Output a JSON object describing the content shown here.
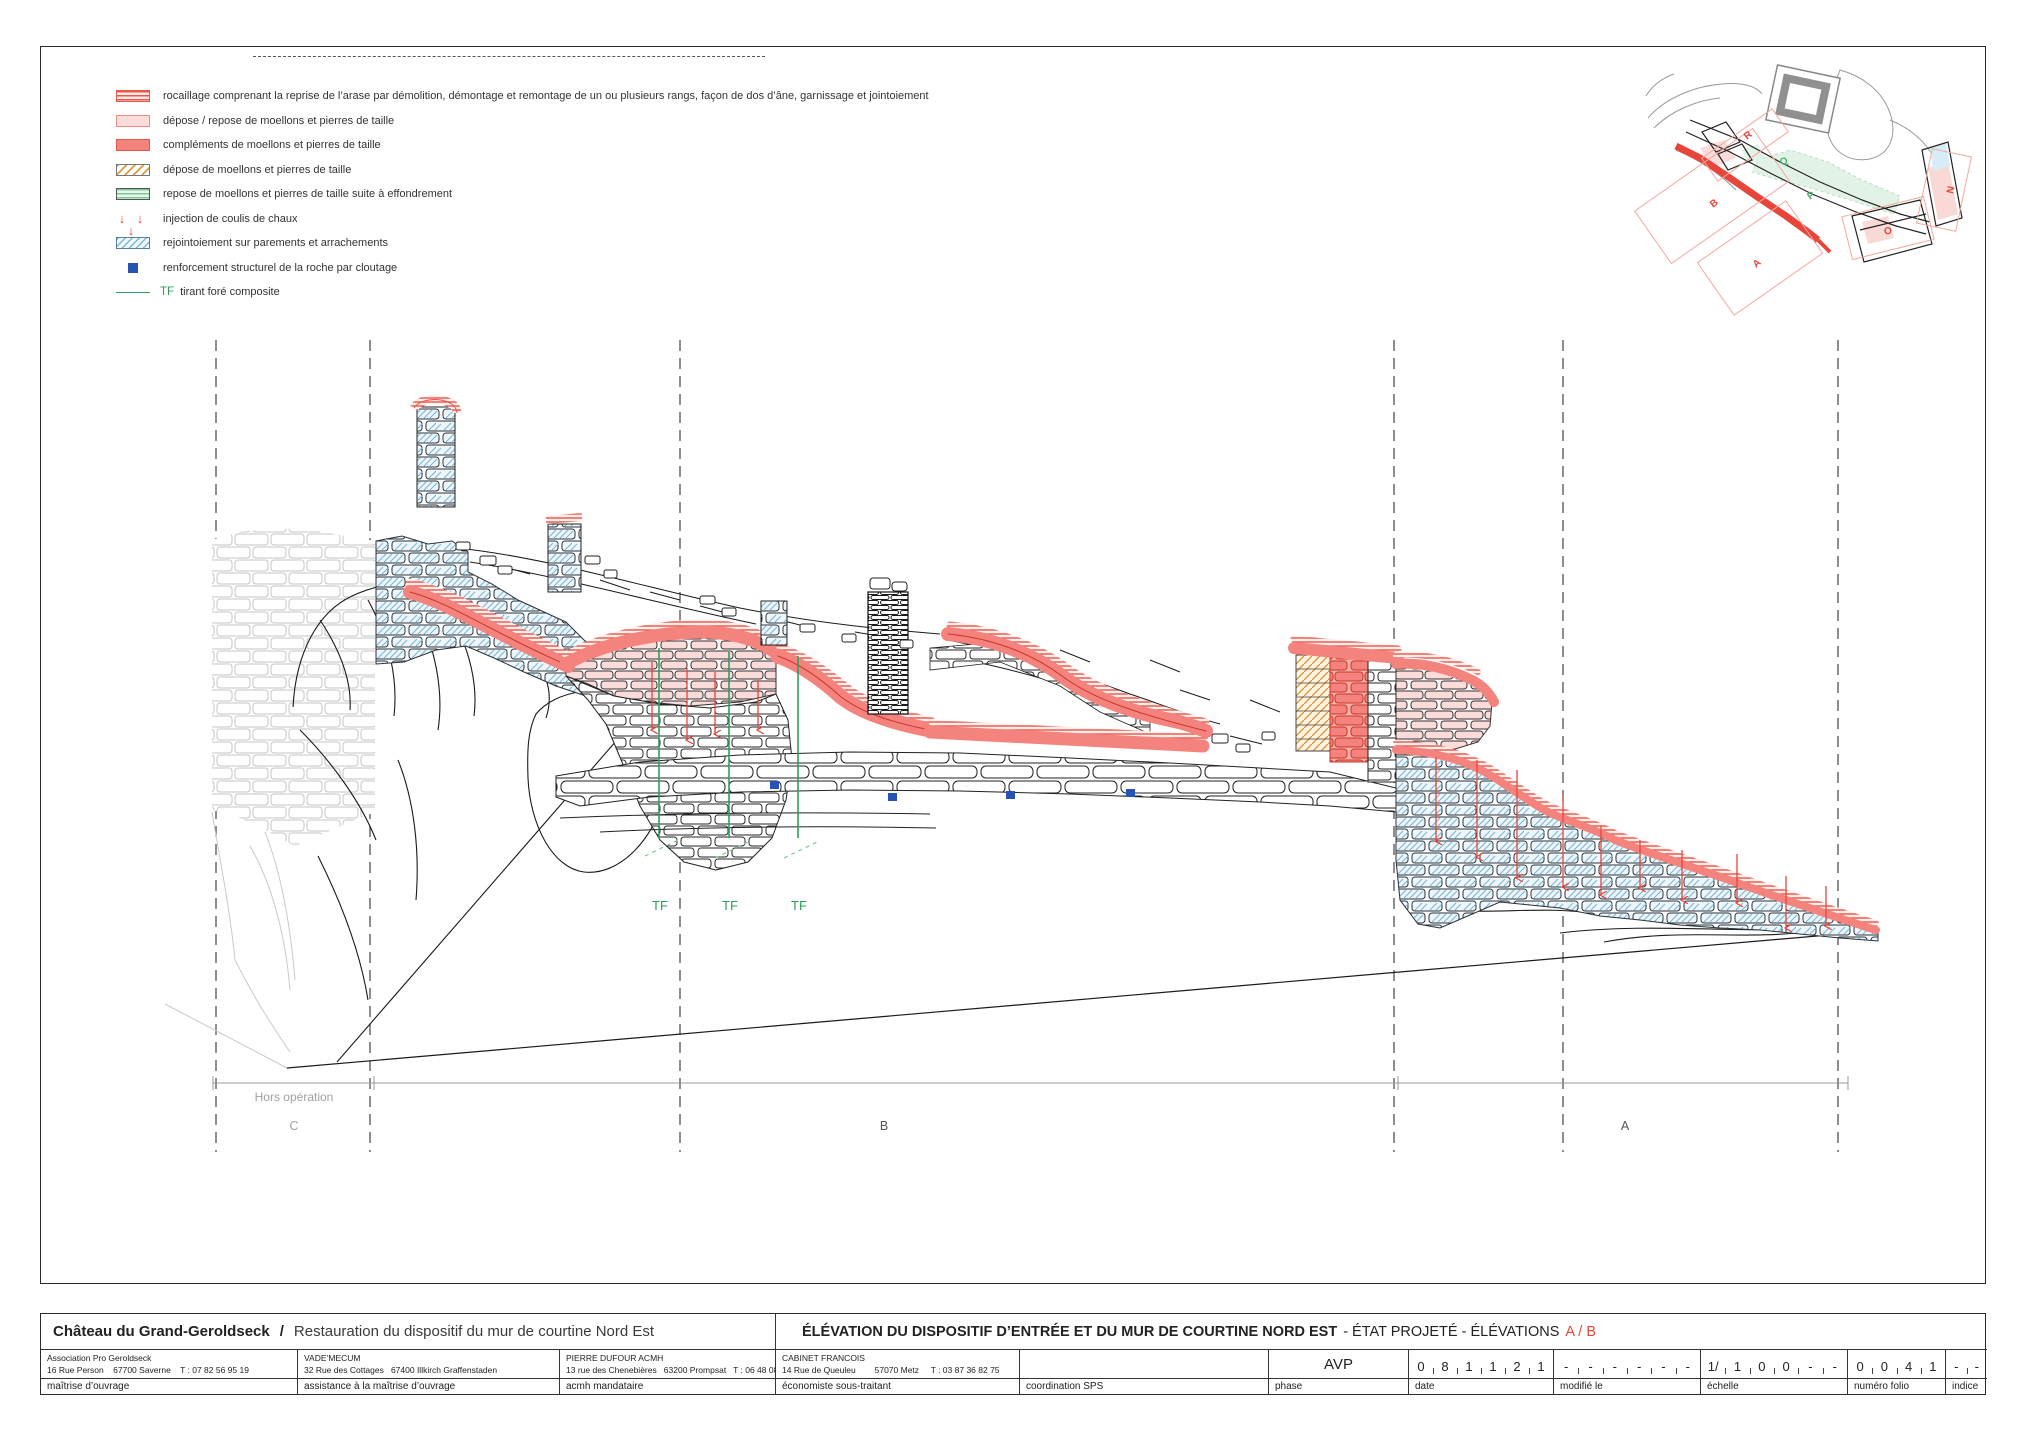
{
  "legend": {
    "items": [
      {
        "swatch": "rocaillage-stripes",
        "label": "rocaillage comprenant la reprise de l’arase par démolition, démontage et remontage de un ou plusieurs rangs, façon de dos d’âne, garnissage et jointoiement"
      },
      {
        "swatch": "pink-solid",
        "label": "dépose / repose de moellons et pierres de taille"
      },
      {
        "swatch": "red-solid",
        "label": "compléments de moellons et pierres de taille"
      },
      {
        "swatch": "orange-hatch",
        "label": "dépose de moellons et pierres de taille"
      },
      {
        "swatch": "green-stripes",
        "label": "repose de moellons et pierres de taille suite à effondrement"
      },
      {
        "swatch": "red-arrows",
        "arrows": "↓ ↓ ↓",
        "label": "injection de coulis de chaux"
      },
      {
        "swatch": "blue-hatch",
        "label": "rejointoiement sur parements et arrachements"
      },
      {
        "swatch": "blue-square",
        "label": "renforcement structurel de la roche par cloutage"
      },
      {
        "swatch": "green-line",
        "prefix": "TF",
        "label": "tirant foré composite"
      }
    ]
  },
  "key_plan": {
    "labels": [
      {
        "text": "R",
        "color": "red"
      },
      {
        "text": "Q",
        "color": "green"
      },
      {
        "text": "B",
        "color": "red"
      },
      {
        "text": "P",
        "color": "green"
      },
      {
        "text": "A",
        "color": "red"
      },
      {
        "text": "O",
        "color": "red"
      },
      {
        "text": "N",
        "color": "red"
      }
    ]
  },
  "drawing": {
    "tf": [
      "TF",
      "TF",
      "TF"
    ],
    "zones": {
      "hors_operation": "Hors opération",
      "c": "C",
      "b": "B",
      "a": "A"
    }
  },
  "title_block": {
    "project_title": "Château du Grand-Geroldseck",
    "project_separator": "/",
    "project_subtitle": "Restauration du dispositif du mur de courtine Nord Est",
    "drawing_title_bold": "ÉLÉVATION DU DISPOSITIF D’ENTRÉE ET DU MUR DE COURTINE NORD EST",
    "drawing_title_rest": "- ÉTAT PROJETÉ - ÉLÉVATIONS",
    "drawing_title_red": "A / B",
    "companies": [
      {
        "name": "Association Pro Geroldseck",
        "address": "16 Rue Person    67700 Saverne    T : 07 82 56 95 19",
        "role": "maîtrise d’ouvrage"
      },
      {
        "name": "VADE’MECUM",
        "address": "32 Rue des Cottages   67400 Illkirch Graffenstaden",
        "role": "assistance à la maîtrise d’ouvrage"
      },
      {
        "name": "PIERRE DUFOUR ACMH",
        "address": "13 rue des Chenebières   63200 Prompsat   T : 06 48 08 91 90",
        "role": "acmh mandataire"
      },
      {
        "name": "CABINET FRANCOIS",
        "address": "14 Rue de Queuleu        57070 Metz     T : 03 87 36 82 75",
        "role": "économiste sous-traitant"
      },
      {
        "name": "",
        "address": "",
        "role": "coordination SPS"
      }
    ],
    "phase": {
      "value": "AVP",
      "label": "phase"
    },
    "date": {
      "cells": [
        "0",
        "8",
        "1",
        "1",
        "2",
        "1"
      ],
      "label": "date"
    },
    "modified": {
      "cells": [
        "-",
        "-",
        "-",
        "-",
        "-",
        "-"
      ],
      "label": "modifié le"
    },
    "scale": {
      "cells": [
        "1/",
        "1",
        "0",
        "0",
        "-",
        "-"
      ],
      "label": "échelle"
    },
    "folio": {
      "cells": [
        "0",
        "0",
        "4",
        "1"
      ],
      "label": "numéro folio"
    },
    "indice": {
      "cells": [
        "-",
        "-"
      ],
      "label": "indice"
    }
  },
  "colors": {
    "red_solid": "#f5837d",
    "red_stroke": "#c9352b",
    "pink": "#fbdcda",
    "stripe_red": "#e8564a",
    "blue_hatch": "#79b7d4",
    "green_tf": "#2e9e5b",
    "blue_square": "#2753b5",
    "injection_red": "#e8453a",
    "gray_stone": "#c5c5c5",
    "orange_hatch": "#dd9a44"
  }
}
